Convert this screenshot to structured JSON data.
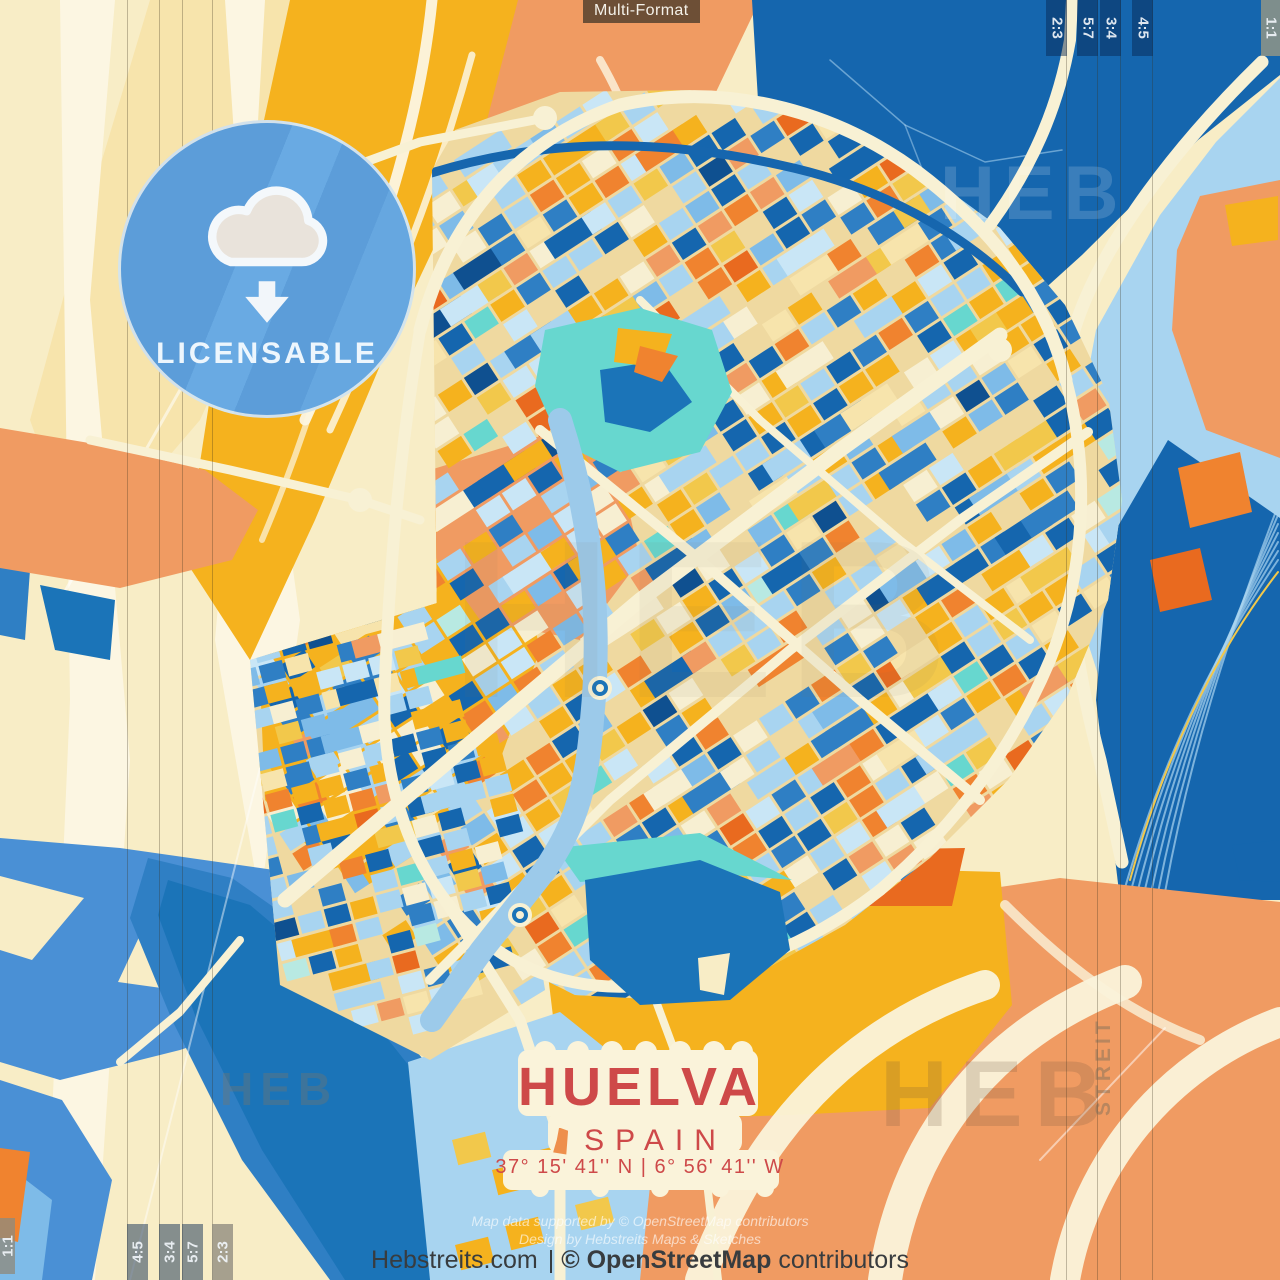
{
  "header": {
    "format_label": "Multi-Format"
  },
  "crop_marks": {
    "square_label": "1:1",
    "top_right": [
      "2:3",
      "5:7",
      "3:4",
      "4:5"
    ],
    "bottom_left": [
      "4:5",
      "3:4",
      "5:7",
      "2:3"
    ]
  },
  "badge": {
    "label": "LICENSABLE",
    "icon": "cloud-download-icon"
  },
  "title_block": {
    "city": "HUELVA",
    "country": "SPAIN",
    "coordinates": "37° 15' 41'' N  |  6° 56' 41'' W"
  },
  "credits": {
    "line1": "Map data supported by © OpenStreetMap contributors",
    "line2": "Design by Hebstreits Maps & Sketches"
  },
  "footer": {
    "site": "Hebstreits.com",
    "separator": "|",
    "osm": "© OpenStreetMap",
    "suffix": "contributors"
  },
  "watermarks": {
    "brand": "HEB",
    "brand_vertical": "STREIT"
  },
  "palette": {
    "base_cream": "#F8EDC6",
    "pale_cream": "#FCF6E2",
    "pale_yellow": "#F7E4AC",
    "gold": "#F5B21E",
    "amber": "#F2C84B",
    "cream_road": "#F8F1D4",
    "salmon": "#F09B62",
    "orange": "#F0832F",
    "deep_orange": "#E96A1F",
    "dark_blue": "#1566AE",
    "mid_blue": "#2F7FC4",
    "royal_blue": "#4A90D5",
    "sky_blue": "#7EBBE8",
    "light_blue": "#A8D4F0",
    "pale_blue": "#C9E6F6",
    "teal": "#67D7CF",
    "pale_teal": "#B8E9E2",
    "navy": "#0F5090",
    "title_red": "#CE4949",
    "badge_blue": "#5FA0DC"
  }
}
